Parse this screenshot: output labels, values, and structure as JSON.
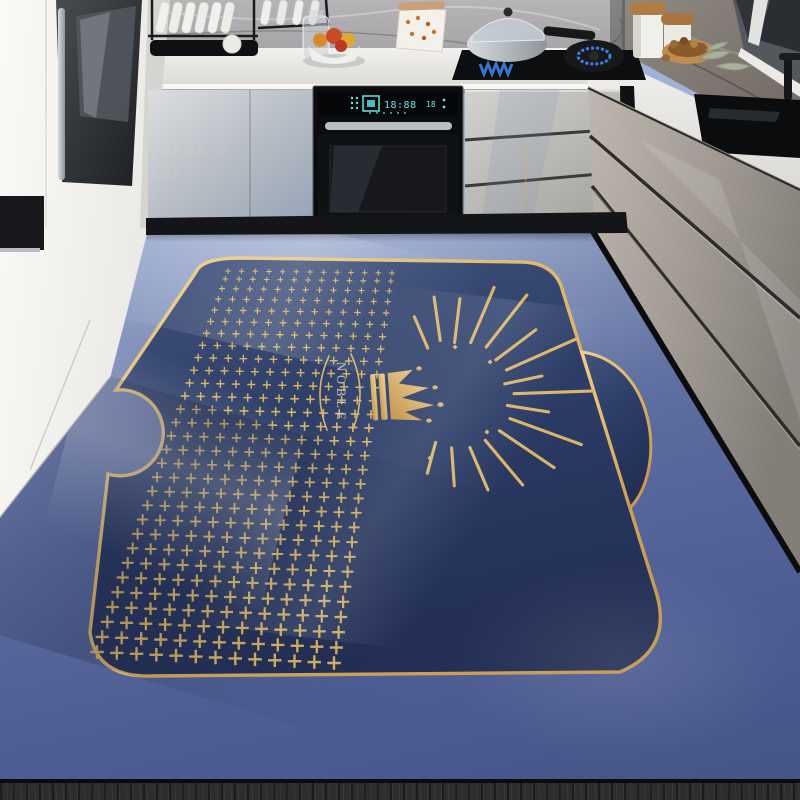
{
  "scene": {
    "mat": {
      "brand_text": "NOBLE",
      "colors": {
        "navy": "#2e3f6a",
        "gold": "#dcb468",
        "outer_top": "#aac1e2",
        "outer_bottom": "#475689"
      },
      "plus_pattern": {
        "columns": 13,
        "rows": 30,
        "color": "#d8b263",
        "quad": {
          "top_left": [
            228,
            271
          ],
          "top_right": [
            392,
            273
          ],
          "bottom_left": [
            97,
            652
          ],
          "bottom_right": [
            334,
            663
          ]
        },
        "min_size": 5.5,
        "max_size": 13.5,
        "row_exponent": 1.15
      },
      "rays": {
        "center": [
          448,
          396
        ],
        "color": "#ddb56a",
        "items": [
          [
            -113,
            52,
            86
          ],
          [
            -98,
            56,
            100
          ],
          [
            -83,
            54,
            98
          ],
          [
            -67,
            58,
            118
          ],
          [
            -52,
            62,
            128
          ],
          [
            -37,
            60,
            110
          ],
          [
            -24,
            64,
            140
          ],
          [
            -12,
            58,
            96
          ],
          [
            -2,
            66,
            146
          ],
          [
            9,
            60,
            102
          ],
          [
            20,
            66,
            142
          ],
          [
            34,
            62,
            128
          ],
          [
            50,
            58,
            116
          ],
          [
            67,
            56,
            102
          ],
          [
            86,
            52,
            90
          ],
          [
            105,
            48,
            80
          ]
        ]
      },
      "spark_dots": [
        [
          455,
          347
        ],
        [
          490,
          362
        ],
        [
          487,
          432
        ],
        [
          430,
          458
        ]
      ]
    },
    "oven": {
      "display_main": "18:88",
      "display_sub": "18",
      "display_color": "#5ce8ee"
    }
  }
}
